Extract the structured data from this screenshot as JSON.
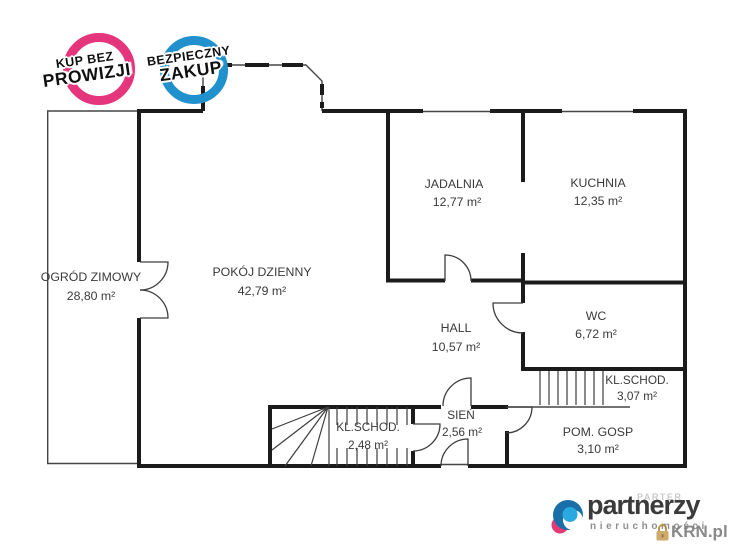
{
  "badges": [
    {
      "line1": "KUP BEZ",
      "line2": "PROWIZJI",
      "color": "#e5357c"
    },
    {
      "line1": "BEZPIECZNY",
      "line2": "ZAKUP",
      "color": "#2191ce"
    }
  ],
  "rooms": [
    {
      "name": "OGRÓD ZIMOWY",
      "area": "28,80 m²"
    },
    {
      "name": "POKÓJ DZIENNY",
      "area": "42,79 m²"
    },
    {
      "name": "JADALNIA",
      "area": "12,77 m²"
    },
    {
      "name": "KUCHNIA",
      "area": "12,35 m²"
    },
    {
      "name": "HALL",
      "area": "10,57 m²"
    },
    {
      "name": "WC",
      "area": "6,72 m²"
    },
    {
      "name": "KL.SCHOD.",
      "area": "3,07 m²"
    },
    {
      "name": "POM. GOSP",
      "area": "3,10 m²"
    },
    {
      "name": "SIEŃ",
      "area": "2,56 m²"
    },
    {
      "name": "KL.SCHOD.",
      "area": "2,48 m²"
    }
  ],
  "logo": {
    "brand": "partnerzy",
    "subtitle": "nieruchomości"
  },
  "watermarks": {
    "floor": "PARTER",
    "site": "KRN.pl"
  },
  "colors": {
    "badge_pink": "#e5357c",
    "badge_blue": "#2191ce",
    "wall": "#1b1b1b",
    "logo_dark": "#3b3b3c",
    "logo_gray": "#8f8f8f",
    "padlock_gold": "#c9a35a"
  }
}
